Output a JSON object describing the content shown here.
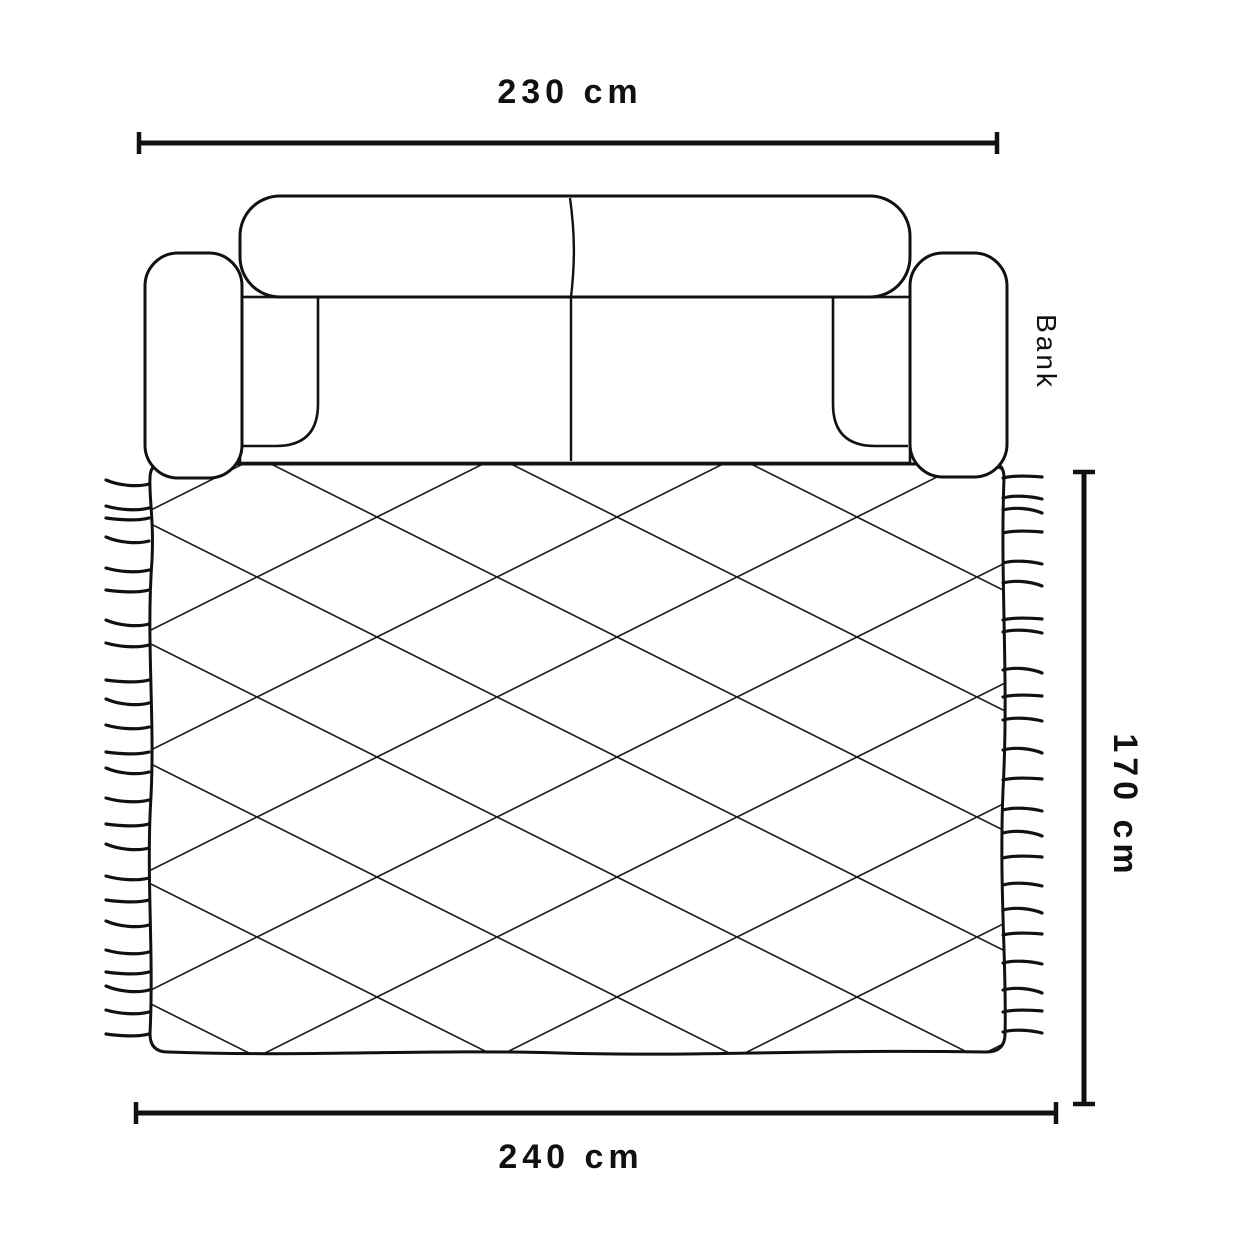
{
  "diagram": {
    "labels": {
      "sofa_width": "230 cm",
      "rug_width": "240 cm",
      "rug_height": "170 cm",
      "sofa_name": "Bank"
    },
    "colors": {
      "line": "#111111",
      "pattern_line": "#1c1c1c",
      "background": "#ffffff"
    }
  }
}
